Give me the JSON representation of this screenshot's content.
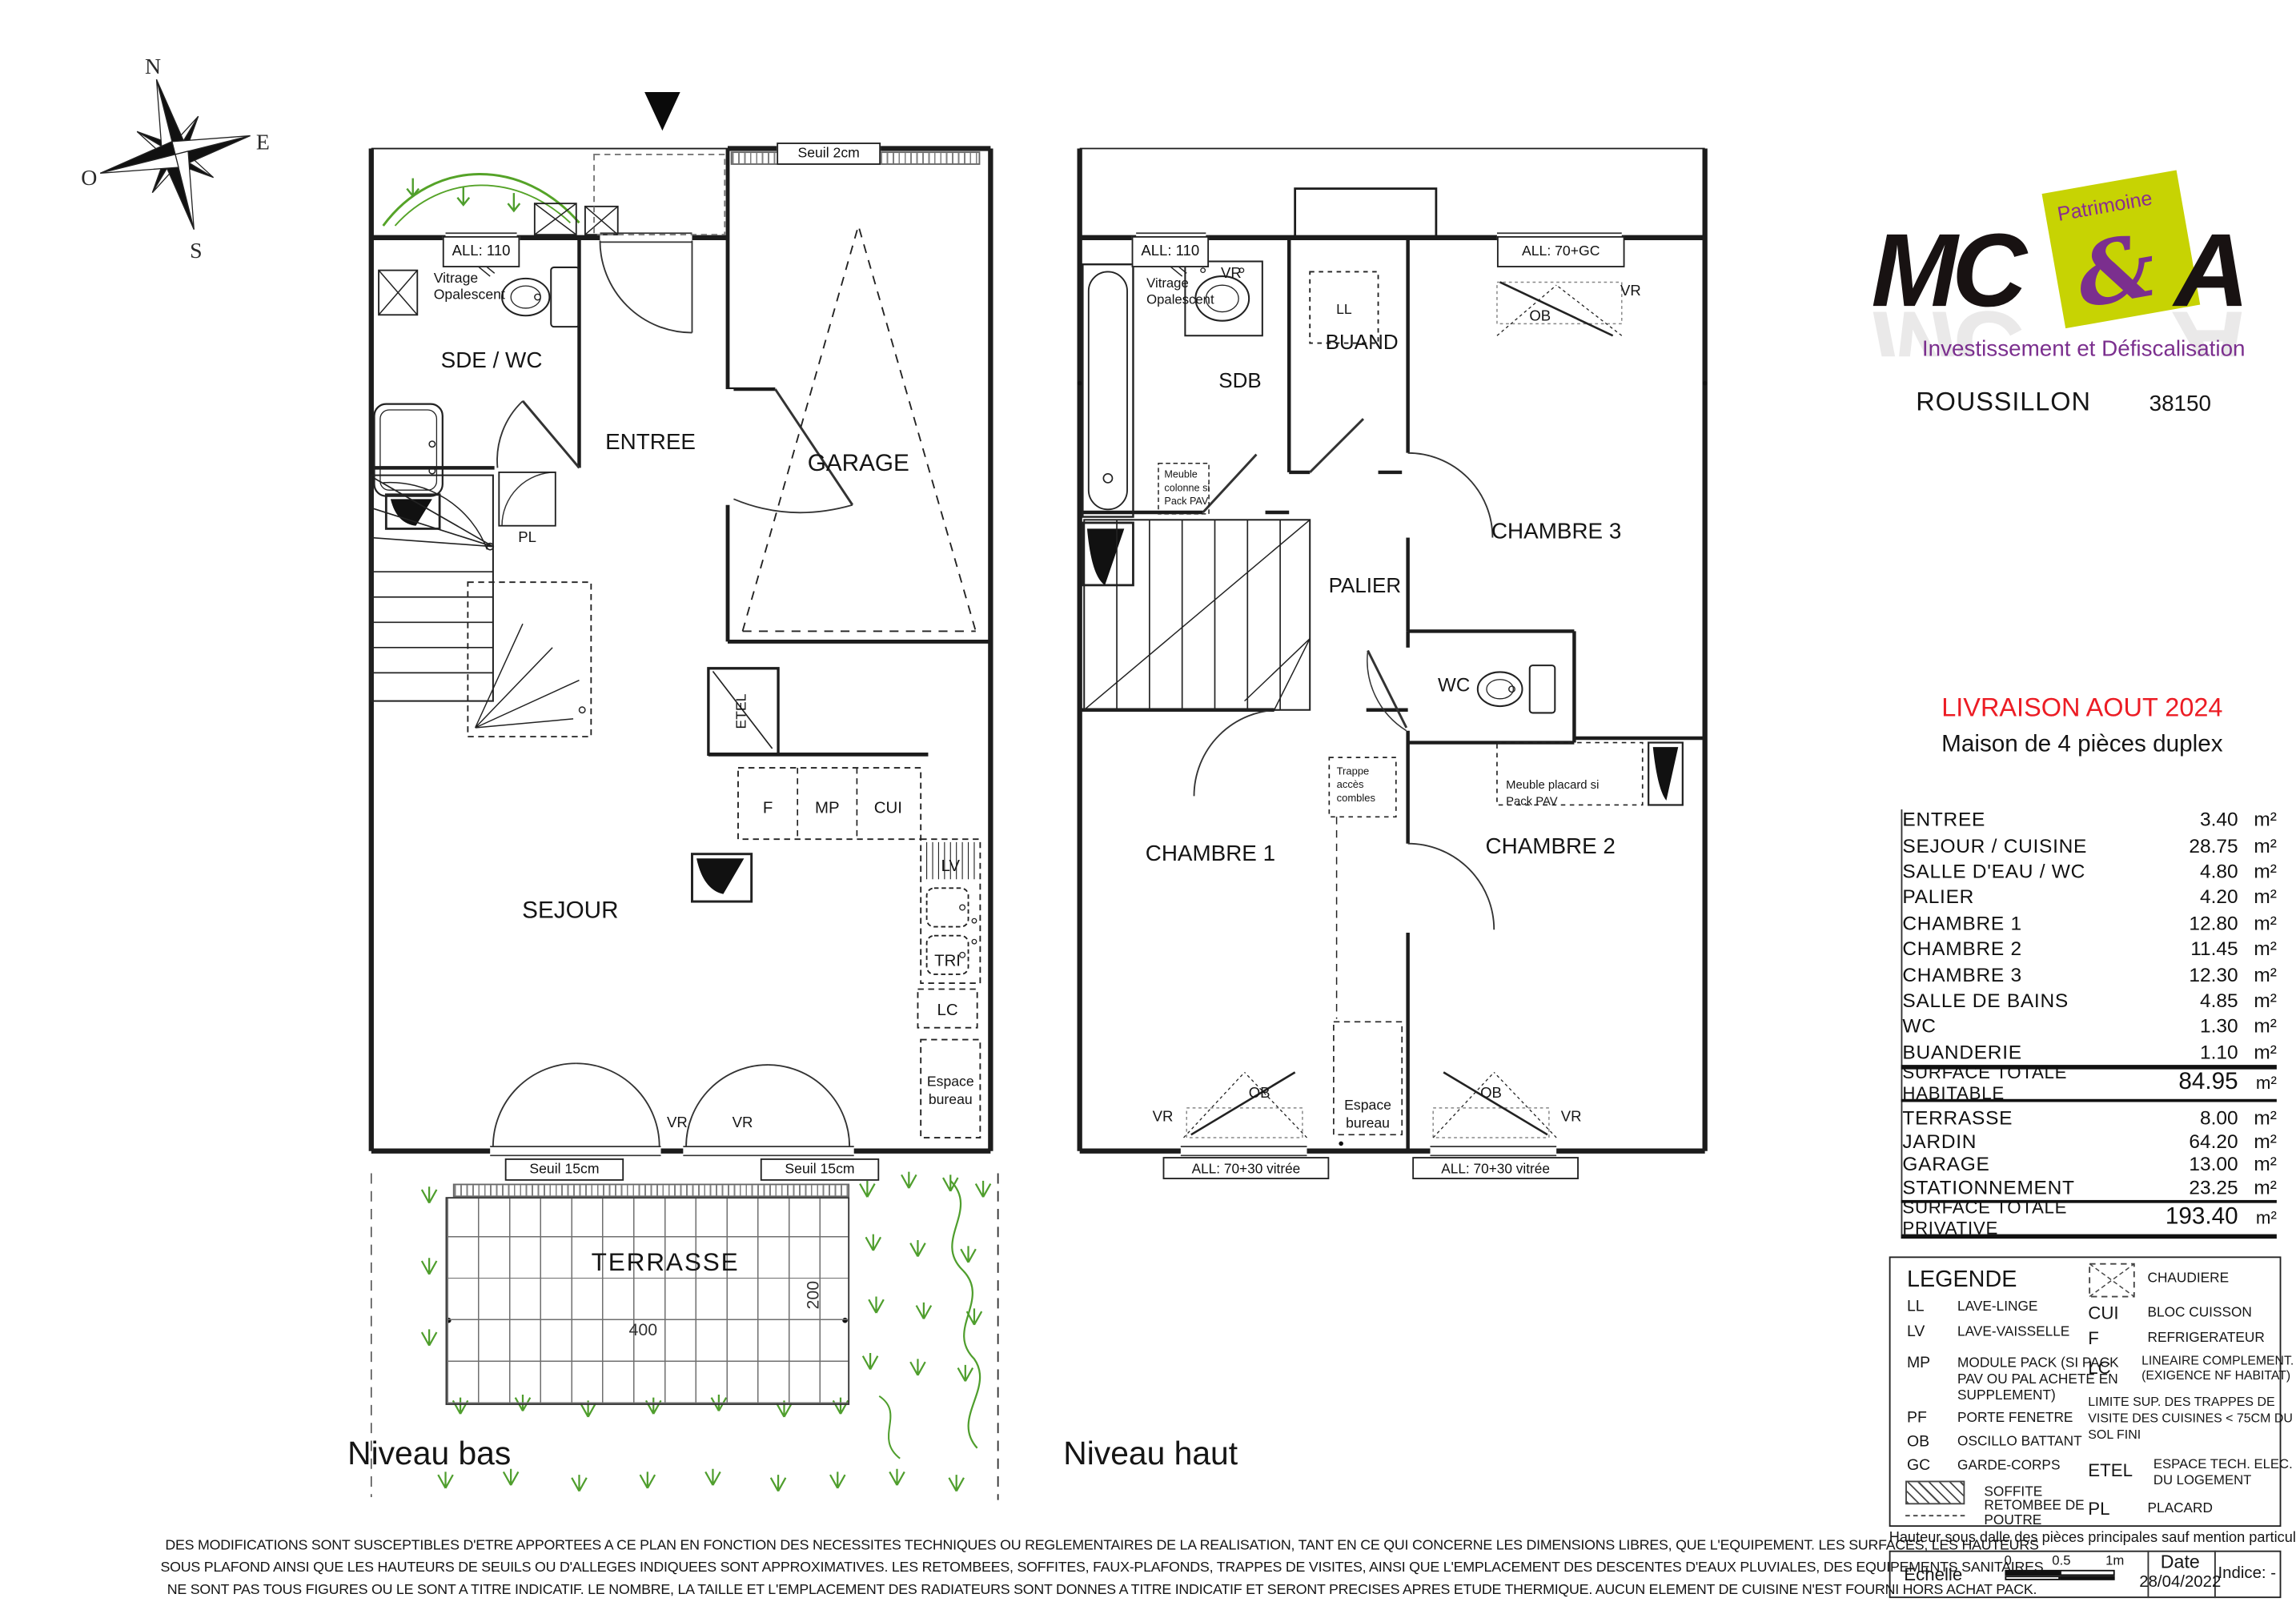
{
  "compass": {
    "n": "N",
    "e": "E",
    "s": "S",
    "o": "O"
  },
  "logo": {
    "mc": "MC",
    "patrimoine": "Patrimoine",
    "ampersand": "&",
    "a": "A",
    "tagline": "Investissement et Défiscalisation",
    "city": "ROUSSILLON",
    "postal_code": "38150"
  },
  "header": {
    "delivery": "LIVRAISON AOUT 2024",
    "program": "Maison de 4 pièces duplex"
  },
  "plan_low": {
    "title": "Niveau bas",
    "all110": "ALL: 110",
    "vitrage_l1": "Vitrage",
    "vitrage_l2": "Opalescent",
    "seuil2": "Seuil 2cm",
    "sde_wc": "SDE / WC",
    "entree": "ENTREE",
    "garage": "GARAGE",
    "sejour": "SEJOUR",
    "pl": "PL",
    "etel": "ETEL",
    "f": "F",
    "mp": "MP",
    "cui": "CUI",
    "lv": "LV",
    "tri": "TRI",
    "lc": "LC",
    "esp_l1": "Espace",
    "esp_l2": "bureau",
    "vr1": "VR",
    "vr2": "VR",
    "seuil15_1": "Seuil 15cm",
    "seuil15_2": "Seuil 15cm",
    "terrasse": "TERRASSE",
    "dim_w": "400",
    "dim_h": "200"
  },
  "plan_high": {
    "title": "Niveau haut",
    "all110": "ALL: 110",
    "vr_win": "VR",
    "vitrage_l1": "Vitrage",
    "vitrage_l2": "Opalescent",
    "sdb": "SDB",
    "ll": "LL",
    "buand": "BUAND",
    "all70gc": "ALL: 70+GC",
    "ob_top": "OB",
    "vr_top": "VR",
    "chambre3": "CHAMBRE 3",
    "palier": "PALIER",
    "wc": "WC",
    "trappe_l1": "Trappe",
    "trappe_l2": "accès",
    "trappe_l3": "combles",
    "colonne_l1": "Meuble",
    "colonne_l2": "colonne si",
    "colonne_l3": "Pack PAV",
    "placard_l1": "Meuble placard si",
    "placard_l2": "Pack PAV",
    "chambre1": "CHAMBRE 1",
    "chambre2": "CHAMBRE 2",
    "esp_l1": "Espace",
    "esp_l2": "bureau",
    "ob_left": "OB",
    "ob_right": "OB",
    "vr_left": "VR",
    "vr_right": "VR",
    "all7030_1": "ALL: 70+30 vitrée",
    "all7030_2": "ALL: 70+30 vitrée"
  },
  "areas": {
    "unit": "m²",
    "rows": [
      {
        "label": "ENTREE",
        "value": "3.40"
      },
      {
        "label": "SEJOUR / CUISINE",
        "value": "28.75"
      },
      {
        "label": "SALLE D'EAU / WC",
        "value": "4.80"
      },
      {
        "label": "PALIER",
        "value": "4.20"
      },
      {
        "label": "CHAMBRE 1",
        "value": "12.80"
      },
      {
        "label": "CHAMBRE 2",
        "value": "11.45"
      },
      {
        "label": "CHAMBRE 3",
        "value": "12.30"
      },
      {
        "label": "SALLE DE BAINS",
        "value": "4.85"
      },
      {
        "label": "WC",
        "value": "1.30"
      },
      {
        "label": "BUANDERIE",
        "value": "1.10"
      }
    ],
    "habitable_label": "SURFACE TOTALE HABITABLE",
    "habitable_value": "84.95",
    "ext_rows": [
      {
        "label": "TERRASSE",
        "value": "8.00"
      },
      {
        "label": "JARDIN",
        "value": "64.20"
      },
      {
        "label": "GARAGE",
        "value": "13.00"
      },
      {
        "label": "STATIONNEMENT",
        "value": "23.25"
      }
    ],
    "privative_label": "SURFACE TOTALE PRIVATIVE",
    "privative_value": "193.40"
  },
  "legend": {
    "title": "LEGENDE",
    "ll_a": "LL",
    "ll_d": "LAVE-LINGE",
    "lv_a": "LV",
    "lv_d": "LAVE-VAISSELLE",
    "mp_a": "MP",
    "mp_d1": "MODULE PACK (SI PACK",
    "mp_d2": "PAV OU PAL ACHETE EN",
    "mp_d3": "SUPPLEMENT)",
    "pf_a": "PF",
    "pf_d": "PORTE FENETRE",
    "ob_a": "OB",
    "ob_d": "OSCILLO BATTANT",
    "gc_a": "GC",
    "gc_d": "GARDE-CORPS",
    "soffite": "SOFFITE",
    "retombee_l1": "RETOMBEE  DE",
    "retombee_l2": "POUTRE",
    "chaudiere": "CHAUDIERE",
    "cui_a": "CUI",
    "cui_d": "BLOC CUISSON",
    "f_a": "F",
    "f_d": "REFRIGERATEUR",
    "lc_a": "LC",
    "lc_d1": "LINEAIRE COMPLEMENT.",
    "lc_d2": "(EXIGENCE NF HABITAT)",
    "limite_l1": "LIMITE SUP. DES TRAPPES DE",
    "limite_l2": "VISITE DES CUISINES < 75CM DU",
    "limite_l3": "SOL FINI",
    "etel_a": "ETEL",
    "etel_d1": "ESPACE  TECH.  ELEC.",
    "etel_d2": "DU LOGEMENT",
    "pl_a": "PL",
    "pl_d": "PLACARD"
  },
  "footer": {
    "hauteur": "Hauteur sous dalle des pièces principales sauf mention particulière : 2.50 m",
    "echelle": "Echelle",
    "scale_0": "0",
    "scale_05": "0.5",
    "scale_1": "1m",
    "date_label": "Date",
    "date_value": "28/04/2022",
    "indice": "Indice: -"
  },
  "disclaimer": {
    "line1": "DES MODIFICATIONS SONT SUSCEPTIBLES D'ETRE APPORTEES A CE PLAN EN FONCTION DES NECESSITES TECHNIQUES OU REGLEMENTAIRES DE LA REALISATION, TANT EN CE QUI CONCERNE LES DIMENSIONS LIBRES, QUE L'EQUIPEMENT. LES SURFACES, LES HAUTEURS",
    "line2": "SOUS PLAFOND AINSI QUE LES HAUTEURS DE SEUILS OU D'ALLEGES INDIQUEES SONT APPROXIMATIVES. LES RETOMBEES, SOFFITES, FAUX-PLAFONDS, TRAPPES DE VISITES, AINSI QUE L'EMPLACEMENT DES DESCENTES D'EAUX PLUVIALES, DES EQUIPEMENTS SANITAIRES",
    "line3": "NE SONT PAS TOUS FIGURES OU LE SONT A TITRE INDICATIF. LE NOMBRE, LA TAILLE ET L'EMPLACEMENT DES RADIATEURS SONT DONNES A TITRE INDICATIF ET SERONT PRECISES APRES ETUDE THERMIQUE. AUCUN ELEMENT DE CUISINE N'EST FOURNI HORS ACHAT PACK."
  }
}
